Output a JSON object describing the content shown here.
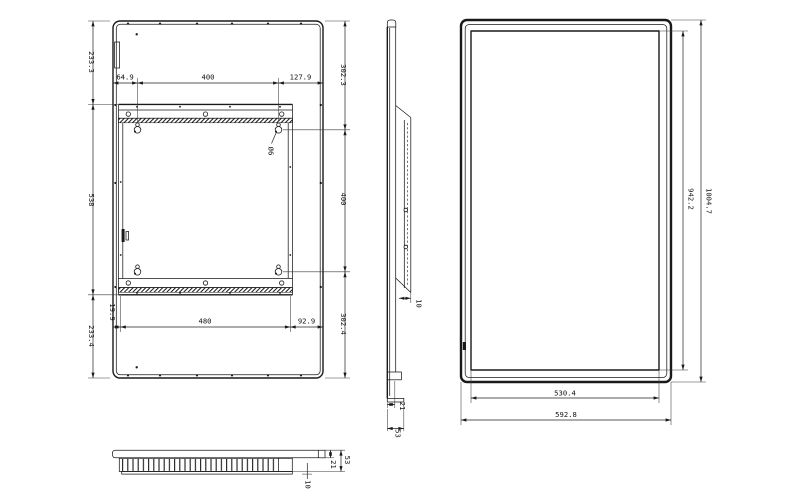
{
  "drawing": {
    "colors": {
      "line": "#1a1a1a",
      "dim_text": "#111111",
      "background": "#ffffff"
    },
    "rear_view": {
      "dims": {
        "left_top": "233.3",
        "left_mid": "538",
        "left_bottom": "233.4",
        "top_left": "64.9",
        "top_mid": "400",
        "top_right": "127.9",
        "right_top": "302.3",
        "right_mid": "400",
        "right_bottom": "302.4",
        "bottom_left": "19.9",
        "bottom_mid": "480",
        "bottom_right": "92.9",
        "hole": "Ø6"
      }
    },
    "side_view": {
      "dims": {
        "bracket_offset": "10",
        "bottom_depth": "21",
        "total_depth": "53"
      }
    },
    "front_view": {
      "dims": {
        "screen_height": "942.2",
        "total_height": "1004.7",
        "screen_width": "530.4",
        "total_width": "592.8"
      }
    },
    "bottom_view": {
      "dims": {
        "bezel_depth": "21",
        "total_depth": "53",
        "vent_offset": "10"
      }
    }
  }
}
